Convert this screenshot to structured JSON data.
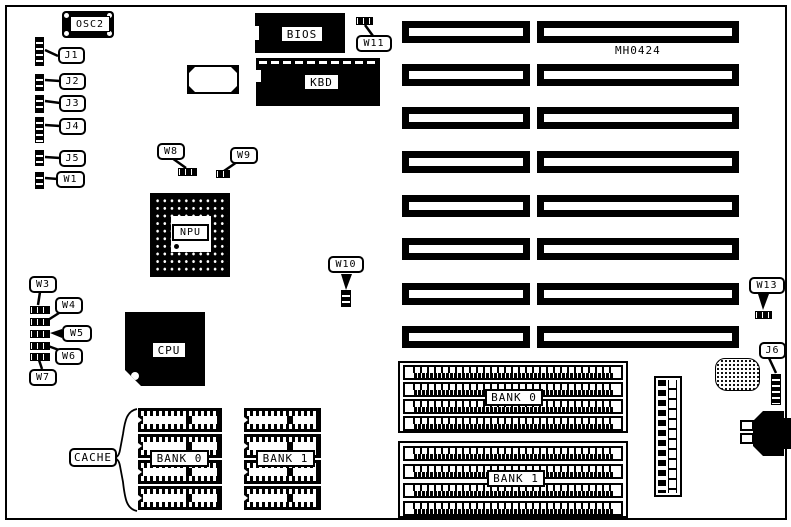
{
  "board": {
    "part_number": "MH0424",
    "ink_color": "#000000",
    "paper_color": "#ffffff"
  },
  "oscillator": {
    "label": "OSC2"
  },
  "left_headers": [
    {
      "label": "J1"
    },
    {
      "label": "J2"
    },
    {
      "label": "J3"
    },
    {
      "label": "J4"
    },
    {
      "label": "J5"
    },
    {
      "label": "W1"
    }
  ],
  "chips": {
    "bios": {
      "label": "BIOS"
    },
    "kbd": {
      "label": "KBD"
    },
    "npu": {
      "label": "NPU"
    },
    "cpu": {
      "label": "CPU"
    }
  },
  "jumpers": {
    "w3": {
      "label": "W3"
    },
    "w4": {
      "label": "W4"
    },
    "w5": {
      "label": "W5"
    },
    "w6": {
      "label": "W6"
    },
    "w7": {
      "label": "W7"
    },
    "w8": {
      "label": "W8"
    },
    "w9": {
      "label": "W9"
    },
    "w10": {
      "label": "W10"
    },
    "w11": {
      "label": "W11"
    },
    "w13": {
      "label": "W13"
    },
    "j6": {
      "label": "J6"
    }
  },
  "cache": {
    "label": "CACHE",
    "banks": [
      {
        "label": "BANK 0"
      },
      {
        "label": "BANK 1"
      }
    ]
  },
  "memory_banks": [
    {
      "label": "BANK 0"
    },
    {
      "label": "BANK 1"
    }
  ],
  "expansion_slots": {
    "rows": 8,
    "slots_per_row": 2
  }
}
